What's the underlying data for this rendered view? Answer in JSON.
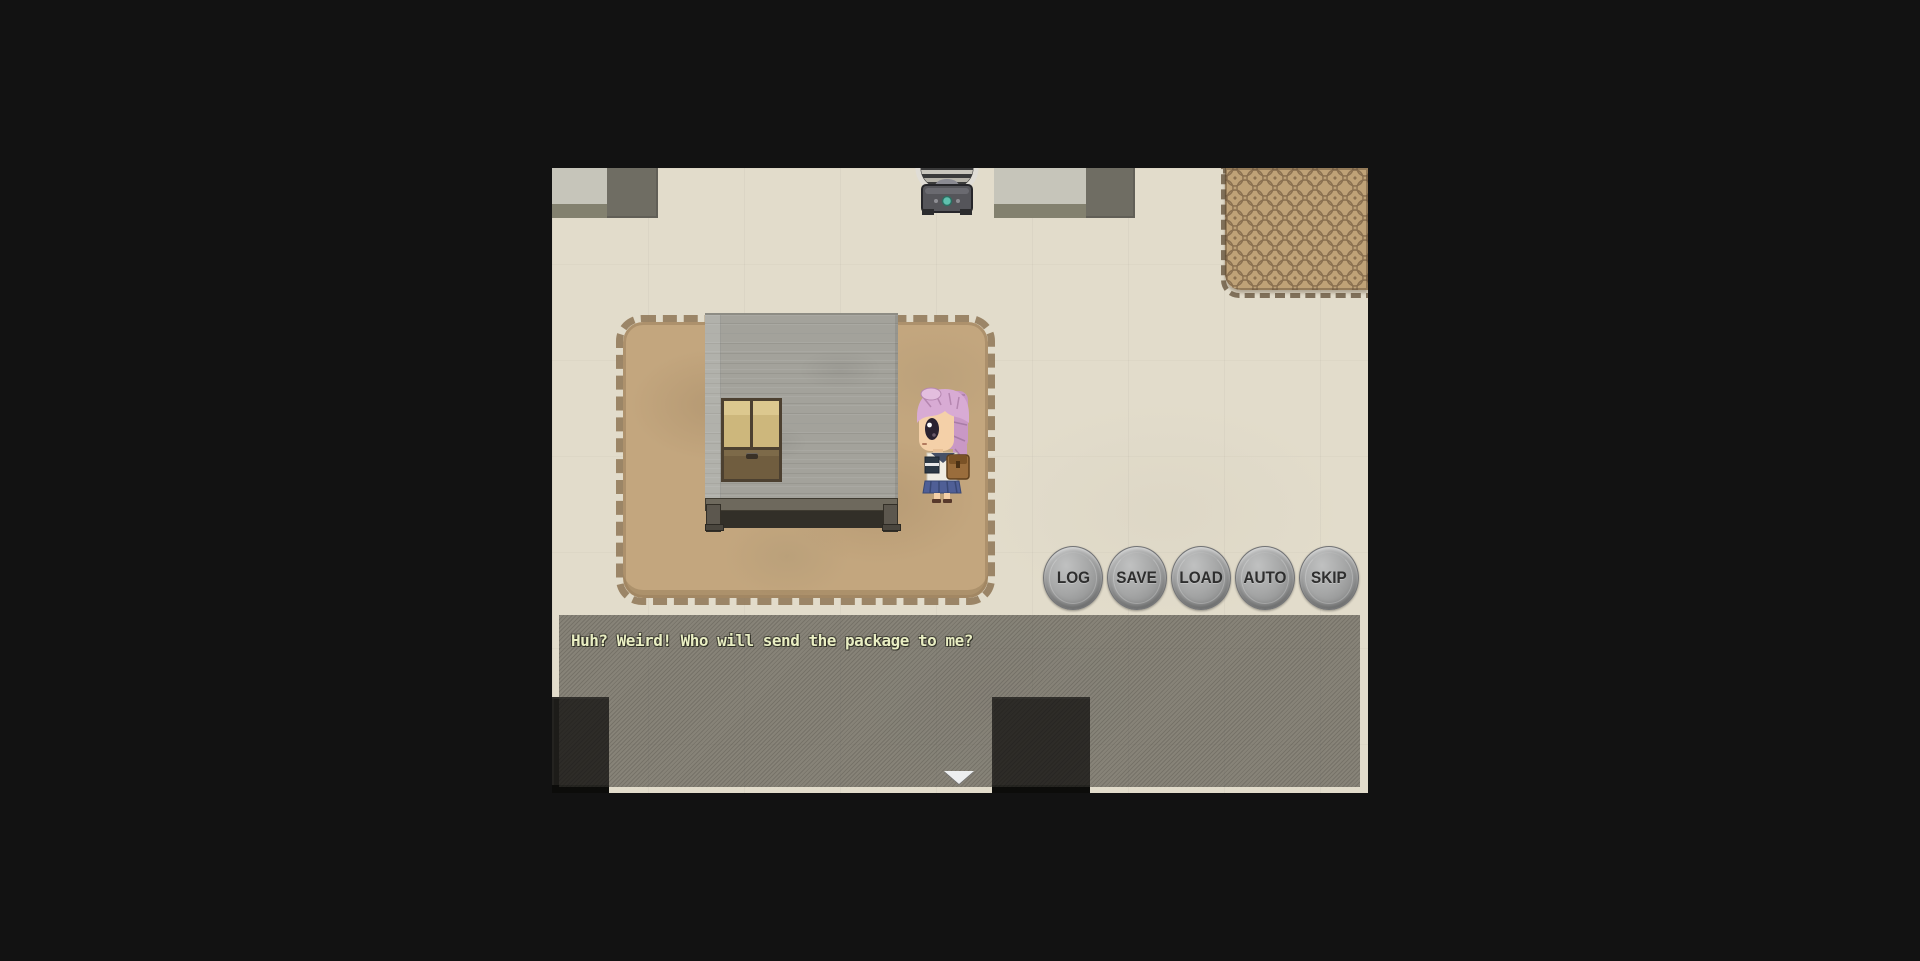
{
  "game": {
    "menu_buttons": [
      {
        "label": "LOG"
      },
      {
        "label": "SAVE"
      },
      {
        "label": "LOAD"
      },
      {
        "label": "AUTO"
      },
      {
        "label": "SKIP"
      }
    ],
    "dialogue": {
      "text": "Huh? Weird! Who will send the package to me?",
      "text_color": "#e9eec3"
    },
    "icons": {
      "continue_arrow": "down-triangle"
    },
    "colors": {
      "page_background": "#121212",
      "floor": "#e2dccb",
      "dialogue_box_overlay": "rgba(60,58,52,0.55)",
      "button_face": "#9fa0a0",
      "button_label": "#2e2e2e",
      "large_rug": "#c3a67e",
      "patterned_rug_base": "#bfa277",
      "patterned_rug_motif": "#8a7050",
      "divider_wall": "#a3a29b",
      "window_pane": "#cdb77c",
      "character_hair": "#d2a5cd",
      "character_skirt": "#4f5f96",
      "lamp_button": "#5fc0ae",
      "dark_furniture": "#1d1c19"
    }
  }
}
